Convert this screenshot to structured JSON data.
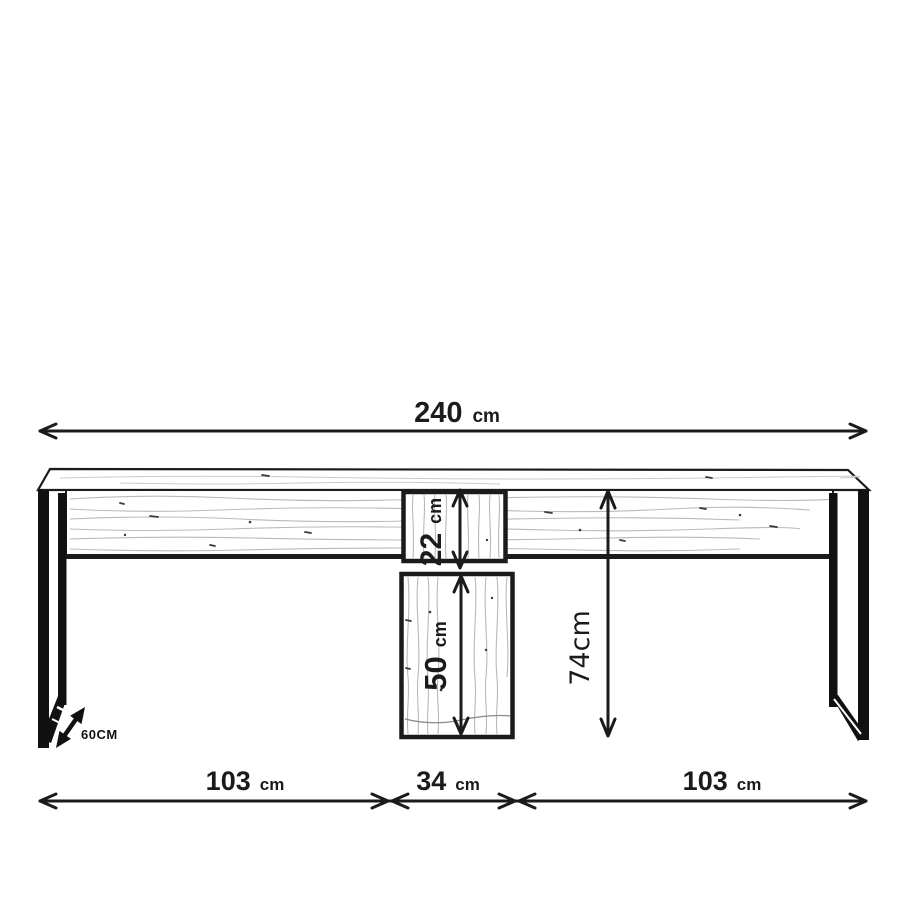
{
  "canvas": {
    "background": "#ffffff",
    "ink": "#1b1b1b",
    "wood_grain": "#b9b9b9"
  },
  "dimensions": {
    "total_width": {
      "value": "240",
      "unit": "cm"
    },
    "left_section": {
      "value": "103",
      "unit": "cm"
    },
    "center_section": {
      "value": "34",
      "unit": "cm"
    },
    "right_section": {
      "value": "103",
      "unit": "cm"
    },
    "height": {
      "value": "74cm"
    },
    "upper_compartment": {
      "value": "22",
      "unit": "cm"
    },
    "lower_compartment": {
      "value": "50",
      "unit": "cm"
    },
    "depth": {
      "value": "60CM"
    }
  }
}
